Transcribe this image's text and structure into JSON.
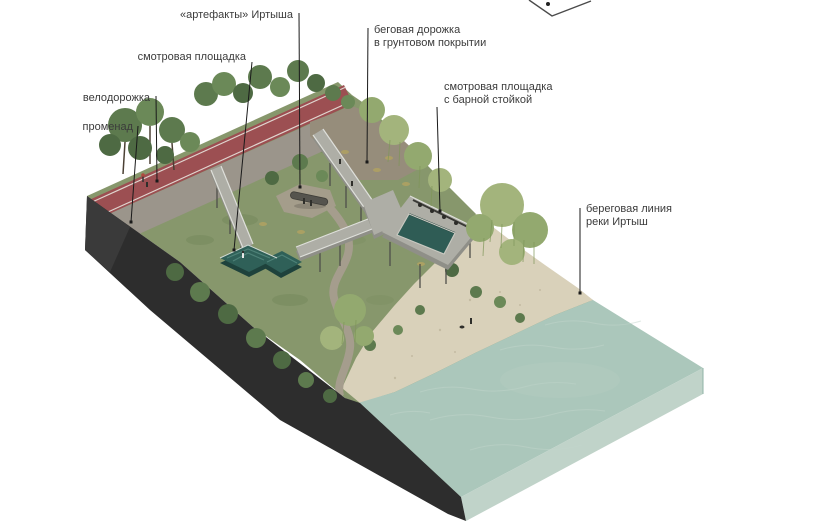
{
  "diagram": {
    "type": "isometric-landscape-site-plan",
    "subject": "riverbank park section with walkways descending to the Irtysh river"
  },
  "annotations": [
    {
      "id": "artefacts",
      "lines": [
        "«артефакты» Иртыша"
      ],
      "side": "left",
      "x": 293,
      "y": 9,
      "line": {
        "x1": 299,
        "y1": 13,
        "x2": 300,
        "y2": 187
      }
    },
    {
      "id": "running-track",
      "lines": [
        "беговая дорожка",
        "в грунтовом покрытии"
      ],
      "side": "right",
      "x": 374,
      "y": 24,
      "line": {
        "x1": 368,
        "y1": 28,
        "x2": 367,
        "y2": 162
      }
    },
    {
      "id": "viewing-platform",
      "lines": [
        "смотровая площадка"
      ],
      "side": "left",
      "x": 246,
      "y": 51,
      "line": {
        "x1": 252,
        "y1": 62,
        "x2": 234,
        "y2": 250
      }
    },
    {
      "id": "bike-path",
      "lines": [
        "велодорожка"
      ],
      "side": "left",
      "x": 150,
      "y": 92,
      "line": {
        "x1": 156,
        "y1": 96,
        "x2": 157,
        "y2": 181
      }
    },
    {
      "id": "promenade",
      "lines": [
        "променад"
      ],
      "side": "left",
      "x": 133,
      "y": 121,
      "line": {
        "x1": 138,
        "y1": 126,
        "x2": 131,
        "y2": 222
      }
    },
    {
      "id": "viewing-platform-bar",
      "lines": [
        "смотровая площадка",
        "с барной стойкой"
      ],
      "side": "right",
      "x": 444,
      "y": 81,
      "line": {
        "x1": 437,
        "y1": 107,
        "x2": 440,
        "y2": 211
      }
    },
    {
      "id": "shoreline",
      "lines": [
        "береговая линия",
        "реки Иртыш"
      ],
      "side": "right",
      "x": 586,
      "y": 203,
      "line": {
        "x1": 580,
        "y1": 208,
        "x2": 580,
        "y2": 293
      }
    }
  ],
  "compass": {
    "partial": true
  },
  "colors": {
    "background": "#ffffff",
    "label_text": "#3b3b3b",
    "leader_line": "#1a1a1a",
    "slope_face": "#2d2d2d",
    "grass": "#87976c",
    "bike_path": "#9c4f52",
    "promenade": "#9b958b",
    "dirt_track": "#968d7b",
    "walkway": "#aeaea6",
    "walkway_wall": "#8f8f88",
    "platform_teal": "#2f6058",
    "pool_water": "#2f5c55",
    "sand": "#d9d1ba",
    "water": "#abc7bb",
    "water_side": "#c0d3c9"
  }
}
